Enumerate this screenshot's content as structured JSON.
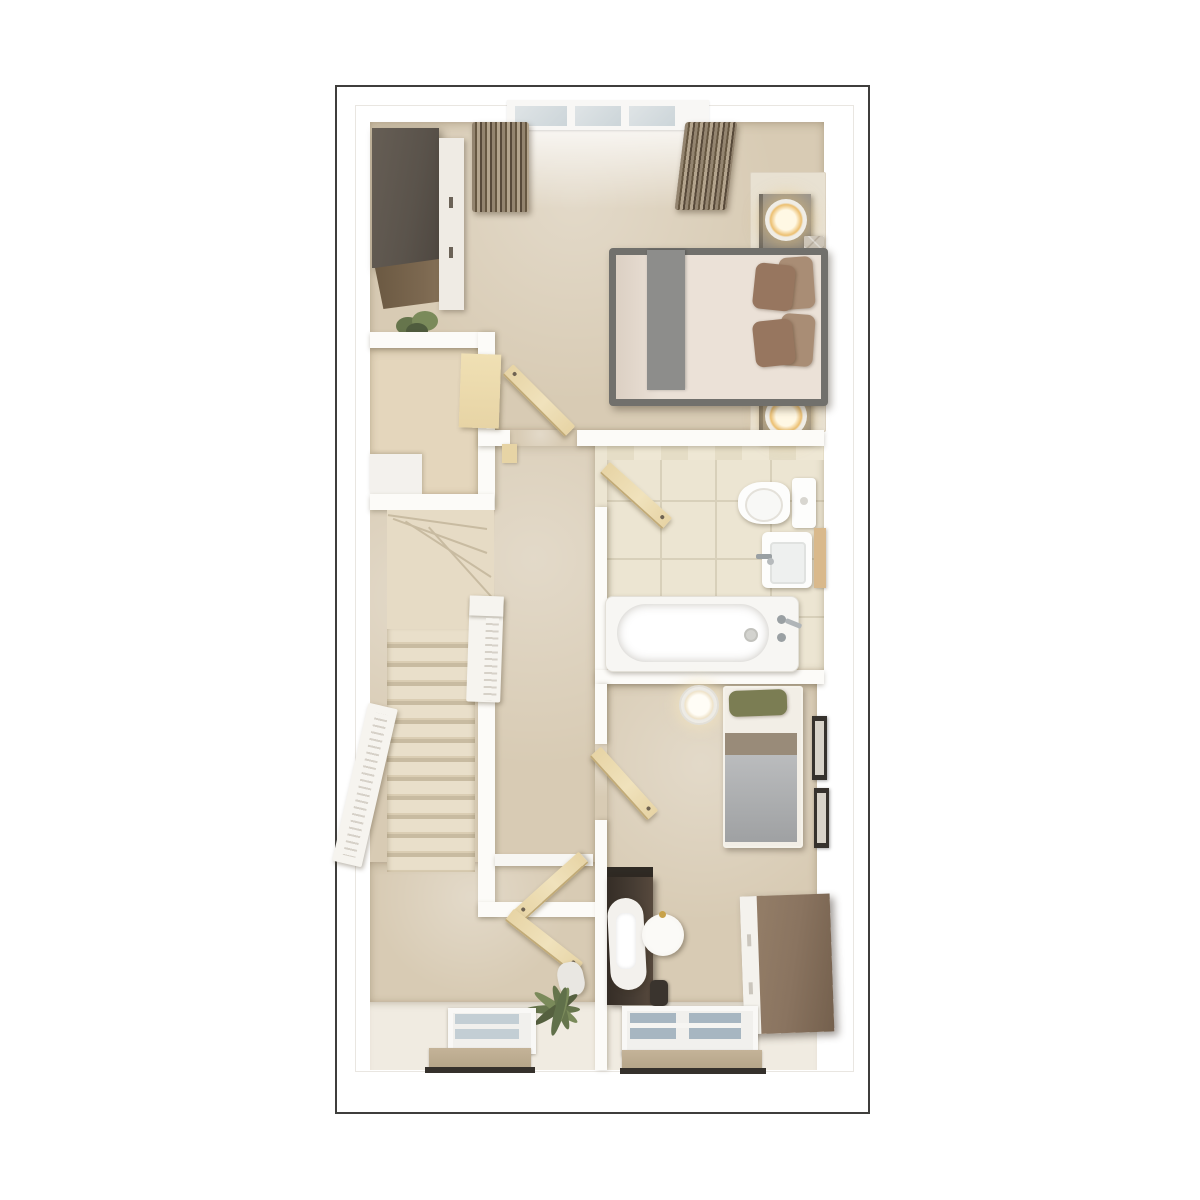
{
  "scene": {
    "type": "floor-plan-3d-render",
    "view": "top-down",
    "description": "Architectural 3D render of an upper floor plan with master bedroom, landing with staircase, bathroom and second bedroom",
    "text_visible": "none"
  },
  "colors": {
    "frame": "#3f3e3c",
    "wall": "#fcfbf8",
    "carpet": "#d8cbb4",
    "smallRoomFloor": "#e4d6bc",
    "cream": "#f0ebe1",
    "tile": "#ece5d2",
    "tileGrout": "#d8d0ba",
    "tileDark": "#e5ddc6",
    "tan": "#e7d4a5",
    "tanEdge": "#c2ab77",
    "wardrobeTop": "#5a534b",
    "wardrobeWood": "#7d6951",
    "doorWhite": "#efebe4",
    "bedFrame": "#71706c",
    "duvet": "#ebe1d7",
    "runner": "#8d8d8b",
    "headboard": "#cdc5b8",
    "pillowDark": "#97765f",
    "pillowLight": "#a98d75",
    "nightstand": "#8e8982",
    "lampGold": "#ecbf70",
    "curtainA": "#93846f",
    "curtainB": "#665741",
    "curtainC": "#b3a48d",
    "glassTop": "#ccd5d9",
    "glassA": "#c3ced4",
    "glassB": "#a7b6c1",
    "tread": "#e9dfca",
    "treadShadow": "#c8bba1",
    "balustrade": "#f6f4ef",
    "radiator": "#b5a589",
    "radiatorDark": "#35312c",
    "plantGreen": "#66754c",
    "plantGreenLight": "#7a8a5a",
    "pot": "#e9e7e2",
    "bed2Green": "#7b7d53",
    "bed2Taupe": "#998b79",
    "bed2Grey": "#a9abad",
    "bed2Sheet": "#f2eee6",
    "deskDark": "#473d34",
    "deskTop": "#2f2a24",
    "chairWhite": "#f3f1ed",
    "sideWood": "#8a7460",
    "pictureFrame": "#36322d",
    "chrome": "#9aa0a3",
    "rug": "#e8e1d2"
  },
  "rooms": [
    {
      "name": "master-bedroom",
      "position": "top",
      "furniture": [
        "wardrobe",
        "double-bed",
        "nightstand-with-lamp",
        "nightstand-with-lamp",
        "rug",
        "plant",
        "curtains",
        "triple-window",
        "open-door"
      ]
    },
    {
      "name": "stair-void",
      "position": "mid-left",
      "furniture": [
        "void-opening"
      ]
    },
    {
      "name": "landing",
      "position": "middle",
      "furniture": [
        "staircase-winders",
        "staircase-straight-flight",
        "balustrade",
        "balustrade",
        "open-door",
        "open-door",
        "palm-plant",
        "window",
        "radiator"
      ]
    },
    {
      "name": "bathroom",
      "position": "mid-right",
      "furniture": [
        "bath-with-taps",
        "toilet",
        "basin",
        "towel-caddy",
        "open-door",
        "tiled-floor"
      ]
    },
    {
      "name": "bedroom-2",
      "position": "bottom-right",
      "furniture": [
        "single-bed",
        "bedside-lamp",
        "desk",
        "chair",
        "stool",
        "waste-bin",
        "sideboard",
        "picture-frame",
        "picture-frame",
        "window",
        "radiator",
        "open-door"
      ]
    }
  ]
}
